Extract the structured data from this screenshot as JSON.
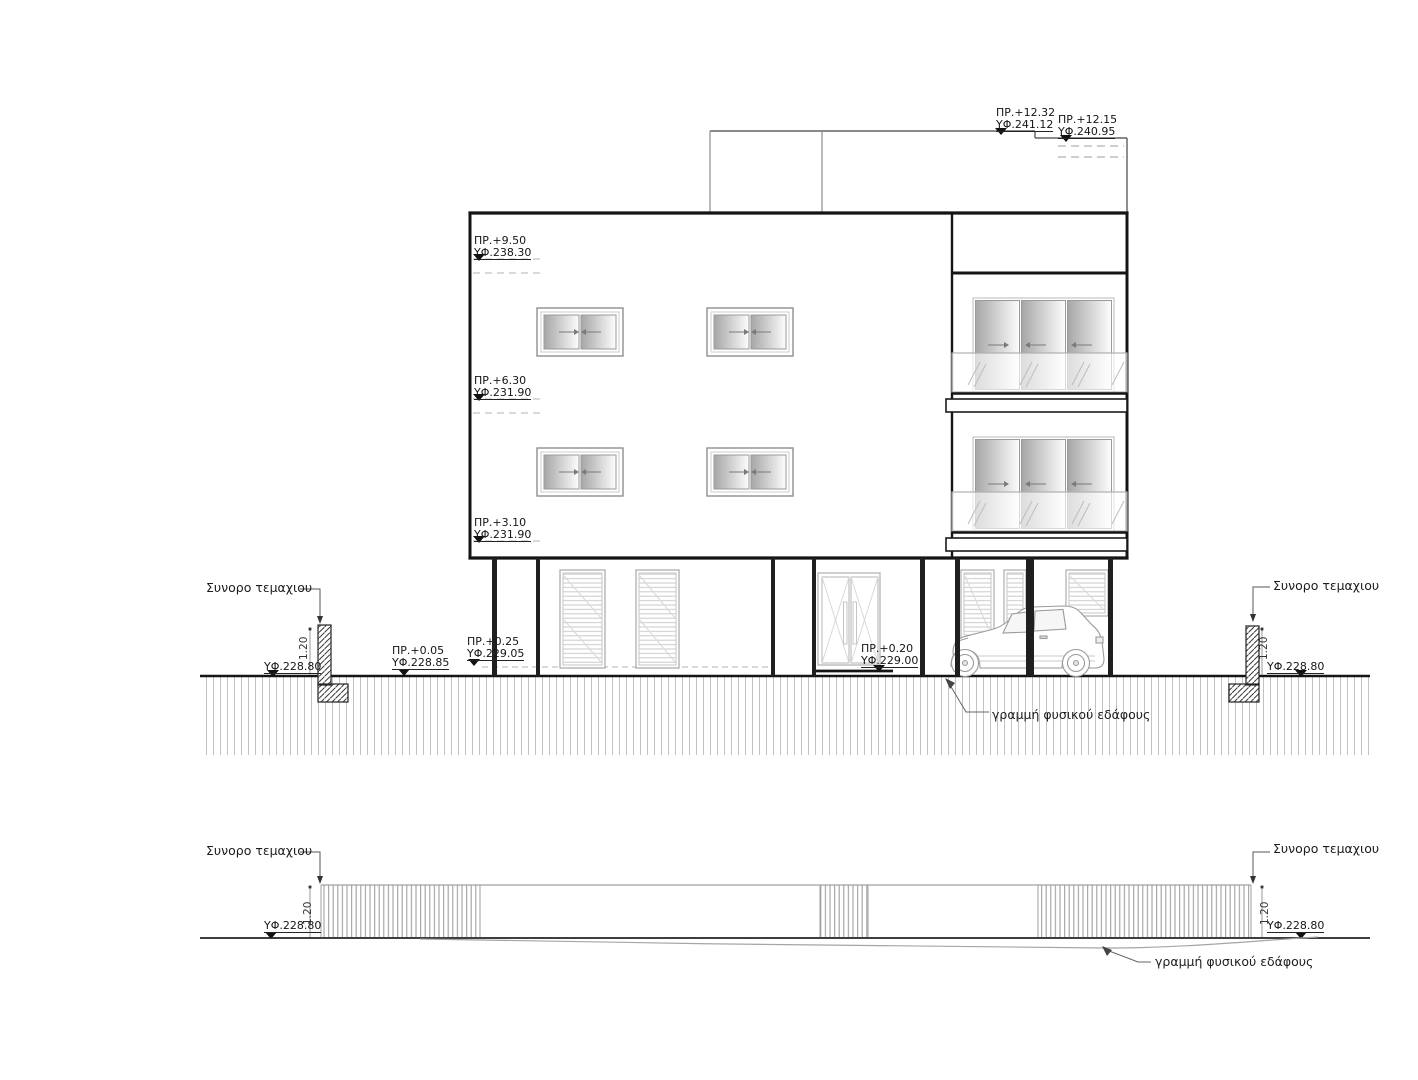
{
  "labels": {
    "plot_boundary": "Συνορο τεμαχιου",
    "natural_ground_line": "γραμμή φυσικού εδάφους",
    "wall_height": "1.20"
  },
  "level_markers": {
    "roof_main": {
      "proposed": "ΠΡ.+12.32",
      "existing": "ΥΦ.241.12"
    },
    "roof_stair": {
      "proposed": "ΠΡ.+12.15",
      "existing": "ΥΦ.240.95"
    },
    "level_950": {
      "proposed": "ΠΡ.+9.50",
      "existing": "ΥΦ.238.30"
    },
    "level_630": {
      "proposed": "ΠΡ.+6.30",
      "existing": "ΥΦ.231.90"
    },
    "level_310": {
      "proposed": "ΠΡ.+3.10",
      "existing": "ΥΦ.231.90"
    },
    "level_005": {
      "proposed": "ΠΡ.+0.05",
      "existing": "ΥΦ.228.85"
    },
    "level_025": {
      "proposed": "ΠΡ.+0.25",
      "existing": "ΥΦ.229.05"
    },
    "level_020": {
      "proposed": "ΠΡ.+0.20",
      "existing": "ΥΦ.229.00"
    },
    "ground_level": "ΥΦ.228.80"
  },
  "colors": {
    "heavy_line": "#141414",
    "light_line": "#9a9a9a",
    "hatch": "#bdbdbd",
    "background": "#ffffff"
  }
}
